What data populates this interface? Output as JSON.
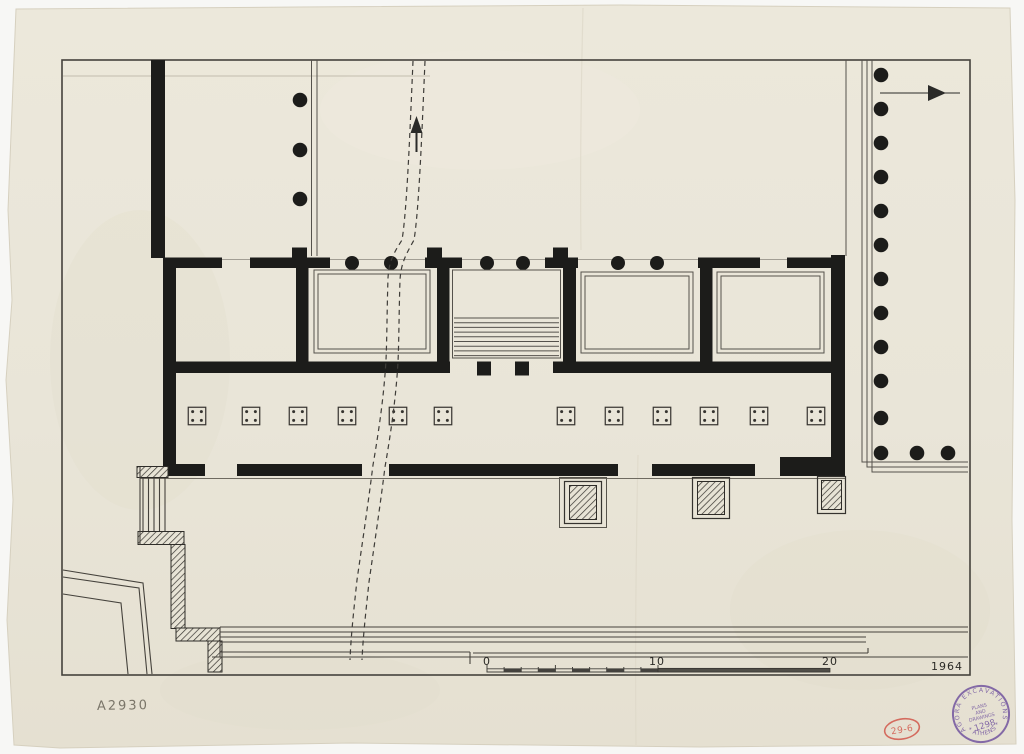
{
  "labels": {
    "inventory_number": "A2930",
    "year": "1964",
    "scale": {
      "zero": "0",
      "ten": "10",
      "twenty": "20"
    },
    "stamps": {
      "purple": {
        "arc_top": "AGORA EXCAVATIONS",
        "arc_bottom": "* ATHENS *",
        "line1": "PLANS",
        "line2": "AND",
        "line3": "DRAWINGS",
        "number": "1298"
      },
      "red": {
        "number": "29-6"
      }
    }
  },
  "colors": {
    "paper": "#e9e5d8",
    "ink": "#1c1c1a",
    "pencil": "#6f6a5e",
    "stamp_purple": "#7b5fa3",
    "stamp_red": "#d2574b"
  }
}
